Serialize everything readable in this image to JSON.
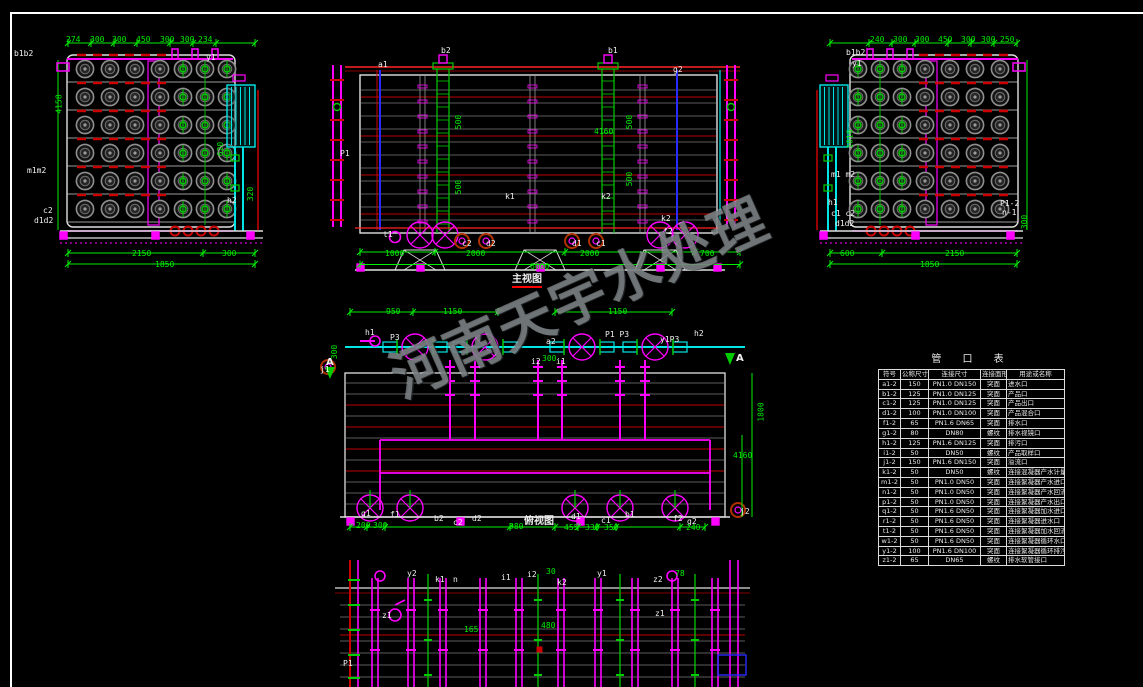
{
  "watermark": {
    "text": "河南天宇水处理"
  },
  "table": {
    "title": "管 口 表",
    "headers": [
      "符号",
      "公称尺寸",
      "连接尺寸",
      "连接面形式",
      "用途或名称"
    ],
    "rows": [
      [
        "a1-2",
        "150",
        "PN1.0 DN150",
        "突面",
        "进水口"
      ],
      [
        "b1-2",
        "125",
        "PN1.0 DN125",
        "突面",
        "产品口"
      ],
      [
        "c1-2",
        "125",
        "PN1.0 DN125",
        "突面",
        "产品出口"
      ],
      [
        "d1-2",
        "100",
        "PN1.0 DN100",
        "突面",
        "产品混合口"
      ],
      [
        "f1-2",
        "65",
        "PN1.6 DN65",
        "突面",
        "排水口"
      ],
      [
        "g1-2",
        "80",
        "DN80",
        "螺纹",
        "排水视镜口"
      ],
      [
        "h1-2",
        "125",
        "PN1.6 DN125",
        "突面",
        "排污口"
      ],
      [
        "i1-2",
        "50",
        "DN50",
        "螺纹",
        "产品取样口"
      ],
      [
        "j1-2",
        "150",
        "PN1.6 DN150",
        "突面",
        "溢流口"
      ],
      [
        "k1-2",
        "50",
        "DN50",
        "螺纹",
        "连接混凝器产水计量口"
      ],
      [
        "m1-2",
        "50",
        "PN1.0 DN50",
        "突面",
        "连接絮凝器产水进口"
      ],
      [
        "n1-2",
        "50",
        "PN1.0 DN50",
        "突面",
        "连接絮凝器产水回流口"
      ],
      [
        "p1-2",
        "50",
        "PN1.0 DN50",
        "突面",
        "连接絮凝器产水出口"
      ],
      [
        "q1-2",
        "50",
        "PN1.6 DN50",
        "突面",
        "连接絮凝器加水进口"
      ],
      [
        "r1-2",
        "50",
        "PN1.6 DN50",
        "突面",
        "连接絮凝器进水口"
      ],
      [
        "t1-2",
        "50",
        "PN1.6 DN50",
        "突面",
        "连接絮凝器加水回流口"
      ],
      [
        "w1-2",
        "50",
        "PN1.6 DN50",
        "突面",
        "连接絮凝器循环水口"
      ],
      [
        "y1-2",
        "100",
        "PN1.6 DN100",
        "突面",
        "连接絮凝器循环排污口"
      ],
      [
        "z1-2",
        "65",
        "DN65",
        "螺纹",
        "排水软管接口"
      ]
    ]
  },
  "views": {
    "left_end": {
      "labels": [
        {
          "t": "b1b2",
          "x": 14,
          "y": 50,
          "c": "w"
        },
        {
          "t": "y1",
          "x": 206,
          "y": 54,
          "c": "w"
        },
        {
          "t": "m1m2",
          "x": 27,
          "y": 167,
          "c": "w"
        },
        {
          "t": "h2",
          "x": 227,
          "y": 197,
          "c": "w"
        },
        {
          "t": "c2",
          "x": 43,
          "y": 207,
          "c": "w"
        },
        {
          "t": "d1d2",
          "x": 34,
          "y": 217,
          "c": "w"
        },
        {
          "t": "274",
          "x": 66,
          "y": 36,
          "c": "g"
        },
        {
          "t": "300",
          "x": 90,
          "y": 36,
          "c": "g"
        },
        {
          "t": "300",
          "x": 112,
          "y": 36,
          "c": "g"
        },
        {
          "t": "450",
          "x": 136,
          "y": 36,
          "c": "g"
        },
        {
          "t": "300",
          "x": 160,
          "y": 36,
          "c": "g"
        },
        {
          "t": "300",
          "x": 180,
          "y": 36,
          "c": "g"
        },
        {
          "t": "234",
          "x": 198,
          "y": 36,
          "c": "g"
        },
        {
          "t": "4158",
          "x": 50,
          "y": 100,
          "c": "g",
          "r": -90
        },
        {
          "t": "620",
          "x": 214,
          "y": 145,
          "c": "g",
          "r": -90
        },
        {
          "t": "320",
          "x": 244,
          "y": 190,
          "c": "g",
          "r": -90
        },
        {
          "t": "2150",
          "x": 132,
          "y": 250,
          "c": "g"
        },
        {
          "t": "300",
          "x": 222,
          "y": 250,
          "c": "g"
        },
        {
          "t": "1850",
          "x": 155,
          "y": 261,
          "c": "g"
        }
      ]
    },
    "front": {
      "labels": [
        {
          "t": "a1",
          "x": 378,
          "y": 61,
          "c": "w"
        },
        {
          "t": "b2",
          "x": 441,
          "y": 47,
          "c": "w"
        },
        {
          "t": "b1",
          "x": 608,
          "y": 47,
          "c": "w"
        },
        {
          "t": "g2",
          "x": 673,
          "y": 66,
          "c": "w"
        },
        {
          "t": "P1",
          "x": 340,
          "y": 150,
          "c": "w"
        },
        {
          "t": "k1",
          "x": 505,
          "y": 193,
          "c": "w"
        },
        {
          "t": "k2",
          "x": 601,
          "y": 193,
          "c": "w"
        },
        {
          "t": "t1",
          "x": 383,
          "y": 231,
          "c": "w"
        },
        {
          "t": "c2",
          "x": 462,
          "y": 240,
          "c": "w"
        },
        {
          "t": "d2",
          "x": 486,
          "y": 240,
          "c": "w"
        },
        {
          "t": "d1",
          "x": 572,
          "y": 240,
          "c": "w"
        },
        {
          "t": "c1",
          "x": 596,
          "y": 240,
          "c": "w"
        },
        {
          "t": "k2",
          "x": 661,
          "y": 215,
          "c": "w"
        },
        {
          "t": "f2",
          "x": 663,
          "y": 228,
          "c": "w"
        },
        {
          "t": "500",
          "x": 452,
          "y": 118,
          "c": "g",
          "r": -90
        },
        {
          "t": "500",
          "x": 452,
          "y": 183,
          "c": "g",
          "r": -90
        },
        {
          "t": "500",
          "x": 623,
          "y": 118,
          "c": "g",
          "r": -90
        },
        {
          "t": "500",
          "x": 623,
          "y": 175,
          "c": "g",
          "r": -90
        },
        {
          "t": "4160",
          "x": 594,
          "y": 128,
          "c": "g"
        },
        {
          "t": "1000",
          "x": 385,
          "y": 250,
          "c": "g"
        },
        {
          "t": "2000",
          "x": 466,
          "y": 250,
          "c": "g"
        },
        {
          "t": "2000",
          "x": 580,
          "y": 250,
          "c": "g"
        },
        {
          "t": "700",
          "x": 700,
          "y": 250,
          "c": "g"
        },
        {
          "t": "6000",
          "x": 530,
          "y": 263,
          "c": "g"
        },
        {
          "t": "主视图",
          "x": 512,
          "y": 275,
          "c": "w",
          "cap": true,
          "u": true
        }
      ]
    },
    "right_end": {
      "labels": [
        {
          "t": "b1b2",
          "x": 846,
          "y": 49,
          "c": "w"
        },
        {
          "t": "y1",
          "x": 852,
          "y": 60,
          "c": "w"
        },
        {
          "t": "m1 m2",
          "x": 831,
          "y": 171,
          "c": "w"
        },
        {
          "t": "h1",
          "x": 828,
          "y": 199,
          "c": "w"
        },
        {
          "t": "c1 c2",
          "x": 831,
          "y": 210,
          "c": "w"
        },
        {
          "t": "d1d2",
          "x": 835,
          "y": 220,
          "c": "w"
        },
        {
          "t": "P1-2",
          "x": 1000,
          "y": 200,
          "c": "w"
        },
        {
          "t": "n-1",
          "x": 1002,
          "y": 209,
          "c": "w"
        },
        {
          "t": "240",
          "x": 870,
          "y": 36,
          "c": "g"
        },
        {
          "t": "300",
          "x": 893,
          "y": 36,
          "c": "g"
        },
        {
          "t": "300",
          "x": 915,
          "y": 36,
          "c": "g"
        },
        {
          "t": "450",
          "x": 938,
          "y": 36,
          "c": "g"
        },
        {
          "t": "300",
          "x": 961,
          "y": 36,
          "c": "g"
        },
        {
          "t": "300",
          "x": 981,
          "y": 36,
          "c": "g"
        },
        {
          "t": "250",
          "x": 1000,
          "y": 36,
          "c": "g"
        },
        {
          "t": "1016",
          "x": 841,
          "y": 135,
          "c": "g",
          "r": -90
        },
        {
          "t": "300",
          "x": 1018,
          "y": 218,
          "c": "g",
          "r": -90
        },
        {
          "t": "600",
          "x": 840,
          "y": 250,
          "c": "g"
        },
        {
          "t": "2150",
          "x": 945,
          "y": 250,
          "c": "g"
        },
        {
          "t": "1850",
          "x": 920,
          "y": 261,
          "c": "g"
        }
      ]
    },
    "plan": {
      "labels": [
        {
          "t": "h1",
          "x": 365,
          "y": 329,
          "c": "w"
        },
        {
          "t": "P3",
          "x": 390,
          "y": 334,
          "c": "w"
        },
        {
          "t": "a2",
          "x": 546,
          "y": 338,
          "c": "w"
        },
        {
          "t": "P1 P3",
          "x": 605,
          "y": 331,
          "c": "w"
        },
        {
          "t": "y1P3",
          "x": 660,
          "y": 336,
          "c": "w"
        },
        {
          "t": "h2",
          "x": 694,
          "y": 330,
          "c": "w"
        },
        {
          "t": "i2",
          "x": 531,
          "y": 358,
          "c": "w"
        },
        {
          "t": "i1",
          "x": 556,
          "y": 358,
          "c": "w"
        },
        {
          "t": "A",
          "x": 736,
          "y": 354,
          "c": "w",
          "cap": true
        },
        {
          "t": "A",
          "x": 326,
          "y": 358,
          "c": "w",
          "cap": true
        },
        {
          "t": "j1",
          "x": 320,
          "y": 366,
          "c": "w"
        },
        {
          "t": "j2",
          "x": 740,
          "y": 508,
          "c": "w"
        },
        {
          "t": "g1",
          "x": 361,
          "y": 510,
          "c": "w"
        },
        {
          "t": "f1",
          "x": 390,
          "y": 511,
          "c": "w"
        },
        {
          "t": "b2",
          "x": 434,
          "y": 515,
          "c": "w"
        },
        {
          "t": "c2",
          "x": 453,
          "y": 519,
          "c": "w"
        },
        {
          "t": "d2",
          "x": 472,
          "y": 515,
          "c": "w"
        },
        {
          "t": "d1",
          "x": 571,
          "y": 513,
          "c": "w"
        },
        {
          "t": "c1",
          "x": 601,
          "y": 517,
          "c": "w"
        },
        {
          "t": "b1",
          "x": 625,
          "y": 511,
          "c": "w"
        },
        {
          "t": "f2",
          "x": 673,
          "y": 515,
          "c": "w"
        },
        {
          "t": "g2",
          "x": 687,
          "y": 518,
          "c": "w"
        },
        {
          "t": "950",
          "x": 386,
          "y": 308,
          "c": "g"
        },
        {
          "t": "1150",
          "x": 443,
          "y": 308,
          "c": "g"
        },
        {
          "t": "1150",
          "x": 608,
          "y": 308,
          "c": "g"
        },
        {
          "t": "300",
          "x": 542,
          "y": 355,
          "c": "g"
        },
        {
          "t": "300",
          "x": 328,
          "y": 348,
          "c": "g",
          "r": -90
        },
        {
          "t": "200",
          "x": 356,
          "y": 522,
          "c": "g"
        },
        {
          "t": "300",
          "x": 373,
          "y": 522,
          "c": "g"
        },
        {
          "t": "980",
          "x": 509,
          "y": 523,
          "c": "g"
        },
        {
          "t": "455",
          "x": 564,
          "y": 524,
          "c": "g"
        },
        {
          "t": "330",
          "x": 585,
          "y": 524,
          "c": "g"
        },
        {
          "t": "350",
          "x": 604,
          "y": 524,
          "c": "g"
        },
        {
          "t": "240",
          "x": 686,
          "y": 524,
          "c": "g"
        },
        {
          "t": "1800",
          "x": 752,
          "y": 408,
          "c": "g",
          "r": -90
        },
        {
          "t": "4160",
          "x": 733,
          "y": 452,
          "c": "g"
        },
        {
          "t": "俯视图",
          "x": 524,
          "y": 517,
          "c": "w",
          "cap": true
        }
      ]
    },
    "partial": {
      "labels": [
        {
          "t": "y2",
          "x": 407,
          "y": 570,
          "c": "w"
        },
        {
          "t": "k1",
          "x": 435,
          "y": 576,
          "c": "w"
        },
        {
          "t": "n",
          "x": 453,
          "y": 576,
          "c": "w"
        },
        {
          "t": "i1",
          "x": 501,
          "y": 574,
          "c": "w"
        },
        {
          "t": "i2",
          "x": 527,
          "y": 571,
          "c": "w"
        },
        {
          "t": "k2",
          "x": 557,
          "y": 579,
          "c": "w"
        },
        {
          "t": "y1",
          "x": 597,
          "y": 570,
          "c": "w"
        },
        {
          "t": "z2",
          "x": 653,
          "y": 576,
          "c": "w"
        },
        {
          "t": "z1",
          "x": 382,
          "y": 612,
          "c": "w"
        },
        {
          "t": "z1",
          "x": 655,
          "y": 610,
          "c": "w"
        },
        {
          "t": "P1",
          "x": 343,
          "y": 660,
          "c": "w"
        },
        {
          "t": "30",
          "x": 546,
          "y": 568,
          "c": "g"
        },
        {
          "t": "78",
          "x": 675,
          "y": 570,
          "c": "g"
        },
        {
          "t": "165",
          "x": 464,
          "y": 626,
          "c": "g"
        },
        {
          "t": "480",
          "x": 541,
          "y": 622,
          "c": "g"
        }
      ]
    }
  }
}
